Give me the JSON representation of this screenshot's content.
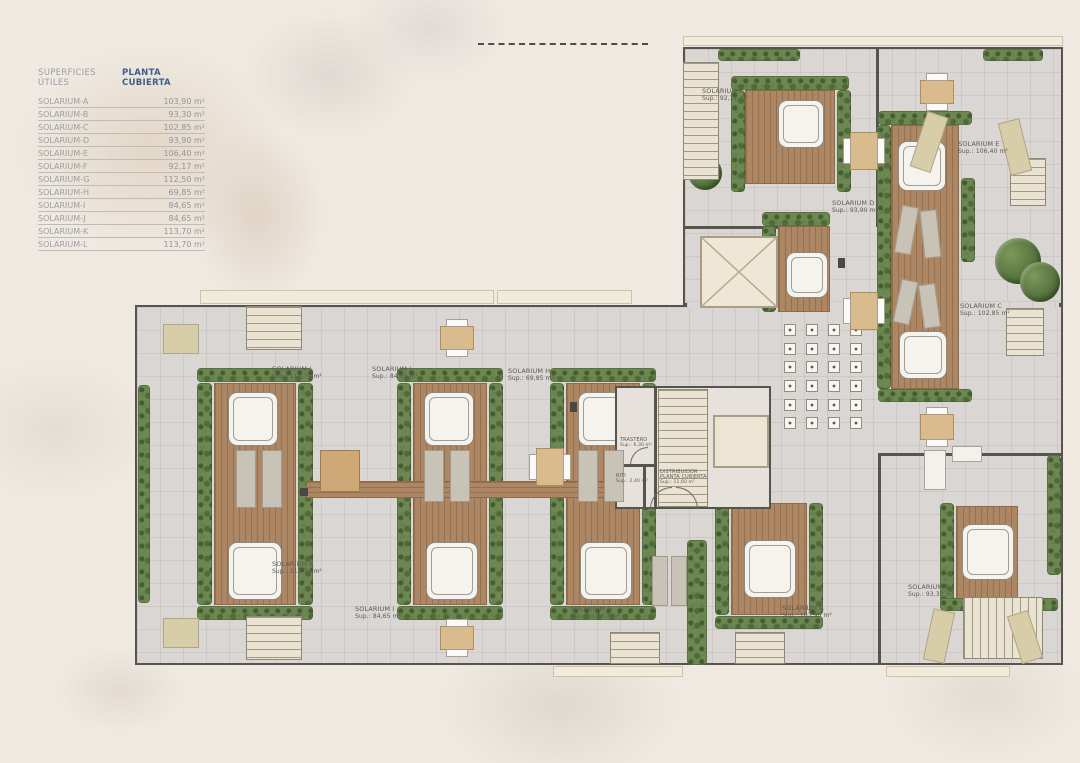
{
  "legend": {
    "title_left": "SUPERFICIES ÚTILES",
    "title_right": "PLANTA CUBIERTA",
    "rows": [
      {
        "name": "SOLARIUM-A",
        "area": "103,90 m²"
      },
      {
        "name": "SOLARIUM-B",
        "area": "93,30 m²"
      },
      {
        "name": "SOLARIUM-C",
        "area": "102,85 m²"
      },
      {
        "name": "SOLARIUM-D",
        "area": "93,90 m²"
      },
      {
        "name": "SOLARIUM-E",
        "area": "106,40 m²"
      },
      {
        "name": "SOLARIUM-F",
        "area": "92,17 m²"
      },
      {
        "name": "SOLARIUM-G",
        "area": "112,50 m²"
      },
      {
        "name": "SOLARIUM-H",
        "area": "69,85 m²"
      },
      {
        "name": "SOLARIUM-I",
        "area": "84,65 m²"
      },
      {
        "name": "SOLARIUM-J",
        "area": "84,65 m²"
      },
      {
        "name": "SOLARIUM-K",
        "area": "113,70 m²"
      },
      {
        "name": "SOLARIUM-L",
        "area": "113,70 m²"
      }
    ]
  },
  "plan": {
    "solarium_a": {
      "name": "SOLARIUM A",
      "sup": "Sup.: 103,90 m²"
    },
    "solarium_b": {
      "name": "SOLARIUM B",
      "sup": "Sup.: 93,30 m²"
    },
    "solarium_c": {
      "name": "SOLARIUM C",
      "sup": "Sup.: 102,85 m²"
    },
    "solarium_d": {
      "name": "SOLARIUM D",
      "sup": "Sup.: 93,90 m²"
    },
    "solarium_e": {
      "name": "SOLARIUM E",
      "sup": "Sup.: 106,40 m²"
    },
    "solarium_f": {
      "name": "SOLARIUM F",
      "sup": "Sup.: 92,17 m²"
    },
    "solarium_g": {
      "name": "SOLARIUM G",
      "sup": "Sup.: 112,50 m²"
    },
    "solarium_h": {
      "name": "SOLARIUM H",
      "sup": "Sup.: 69,85 m²"
    },
    "solarium_i": {
      "name": "SOLARIUM I",
      "sup": "Sup.: 84,65 m²"
    },
    "solarium_j": {
      "name": "SOLARIUM J",
      "sup": "Sup.: 84,65 m²"
    },
    "solarium_k": {
      "name": "SOLARIUM K",
      "sup": "Sup.: 113,70 m²"
    },
    "solarium_l": {
      "name": "SOLARIUM L",
      "sup": "Sup.: 113,70 m²"
    },
    "trastero": {
      "name": "TRASTERO",
      "sup": "Sup.: 6,30 m²"
    },
    "distribuidor": {
      "name": "DISTRIBUIDOR",
      "name2": "PLANTA CUBIERTA",
      "sup": "Sup.: 11,60 m²"
    },
    "riti": {
      "name": "RITI",
      "sup": "Sup.: 2,40 m²"
    }
  },
  "colors": {
    "paper": "#efe9e2",
    "paving": "#d9d6d3",
    "deck_wood": "#ad8663",
    "hedge_green": "#6d8752",
    "wall": "#56544e",
    "jacuzzi": "#f5f3ee",
    "legend_accent": "#3d5f8a"
  }
}
